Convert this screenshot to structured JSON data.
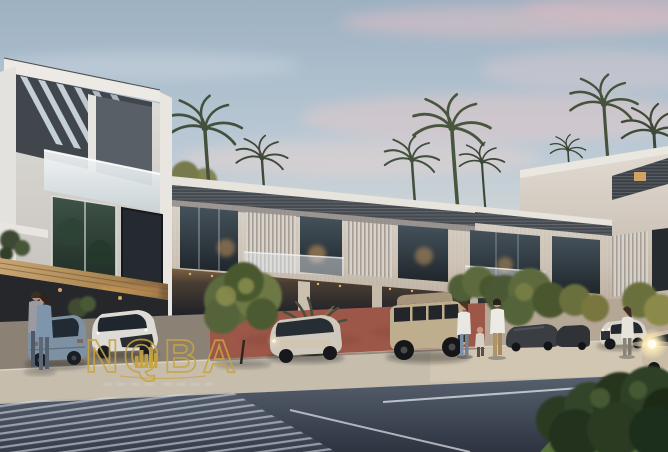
{
  "scene": {
    "type": "architectural-exterior-render",
    "description": "Photorealistic dusk rendering of a modern townhouse community: a three-storey corner villa with a slatted rooftop pergola on the left, a receding two-storey townhouse row with dark slatted roof canopies and warmly lit interiors, palm trees behind the roofline, a landscaped driveway with parked cars, pedestrians, and a striped pedestrian crossing on the street in the foreground.",
    "time_of_day": "dusk",
    "sky": "pale grey-blue sky with pink-tinted clouds, warmer toward the horizon"
  },
  "watermark": {
    "brand_text": "NQBA",
    "emblem": "gold city-skyline silhouette inside the Q letter",
    "style": "thin gold outline lettering",
    "tagline_visible": true,
    "tagline_legible": false
  },
  "colors": {
    "gold": "#c7a442",
    "sky_top": "#9db1c2",
    "sky_horizon": "#eadcd1",
    "cloud_pink": "#e9c6c5",
    "wall_light": "#d6cfc6",
    "roof_slat": "#464b52",
    "glass_dark": "#2b343b",
    "warm_light": "#e8b36a",
    "paving_red": "#9d5749",
    "sidewalk": "#c6bdad",
    "asphalt": "#3f4754",
    "hedge_green": "#2d3d26",
    "palm_green": "#46523c"
  },
  "inventory": {
    "buildings": [
      "three-storey corner villa with diagonal rooftop pergola slats and glass balustrade",
      "two-storey townhouse row with slatted roof overhangs, striped louvre screens and carport arcade",
      "taller white parapet block with pergola at far right"
    ],
    "vehicles": [
      "blue-grey hatchback seen from rear (left)",
      "white compact crossover (left)",
      "silver SUV (centre)",
      "sand-coloured boxy off-road SUV (centre-right)",
      "dark parked cars (right)",
      "white SUV (right)",
      "car driving with headlights on (far right)"
    ],
    "people": [
      "embracing couple beside the parked cars (left)",
      "woman, child and man walking together (centre-right)",
      "woman walking near the road (right)"
    ],
    "vegetation": [
      "palm trees behind the roofline",
      "round ornamental trees and shrubs along the driveway",
      "spiky palm bush between the cars",
      "dark foreground hedge with lawn (bottom right)"
    ],
    "road_features": [
      "striped pedestrian crossing (bottom left)",
      "white lane markings",
      "light sidewalk strip",
      "red paved driveway apron"
    ]
  }
}
